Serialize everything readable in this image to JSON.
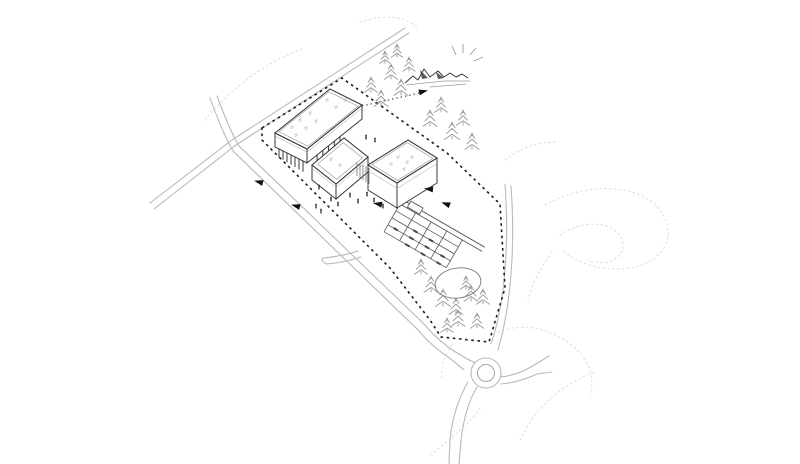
{
  "canvas": {
    "width": 800,
    "height": 464,
    "background": "#ffffff"
  },
  "colors": {
    "ink": "#3a3a3a",
    "ink_light": "#8a8a8a",
    "road": "#b9b9b9",
    "boundary": "#1c1c1c",
    "tree": "#969696",
    "contour": "#dfdfdf",
    "figure": "#141414",
    "arrow": "#111111",
    "roof_mark": "#b3b3b3",
    "mountain": "#3c3c3c",
    "mountain_ray": "#9a9a9a",
    "pond": "#7a7a7a",
    "parking": "#5a5a5a",
    "background": "#ffffff"
  },
  "scene": {
    "site_boundary": {
      "points": [
        [
          262,
          128
        ],
        [
          342,
          78
        ],
        [
          447,
          153
        ],
        [
          500,
          204
        ],
        [
          505,
          288
        ],
        [
          489,
          342
        ],
        [
          441,
          337
        ],
        [
          430,
          320
        ],
        [
          390,
          268
        ],
        [
          262,
          140
        ]
      ],
      "dash": "2.6 3.6",
      "width": 1.6
    },
    "roads": {
      "paths": [
        "M 150,203 L 232,140 L 405,28",
        "M 154,209 L 236,145 L 409,33",
        "M 217,96 Q 230,131 239,146 L 424,324 Q 434,336 448,347 Q 461,356 475,363",
        "M 210,98 Q 223,134 233,151 L 418,330 Q 428,342 441,352 Q 450,358 464,370",
        "M 505,184 C 509,240 506,300 491,344",
        "M 511,186 C 515,242 512,302 498,350",
        "M 477,387 C 469,400 463,420 461,441 L 459,464",
        "M 468,382 C 459,397 452,418 450,440 L 449,464",
        "M 500,377 C 513,376 525,371 536,364 L 549,356",
        "M 501,384 C 513,383 526,379 537,374 L 552,372",
        "M 358,251 C 346,255 334,257 323,258",
        "M 361,257 C 349,261 338,263 327,264",
        "M 323,258 Q 320,261 327,264"
      ]
    },
    "roundabout": {
      "cx": 486,
      "cy": 373,
      "r_outer": 15,
      "r_inner": 8.5
    },
    "view_axis": {
      "x1": 362,
      "y1": 106,
      "x2": 419,
      "y2": 93,
      "arrow": [
        423,
        91.5,
        -13
      ]
    },
    "mountain": {
      "ridge": "M 405,83 L 413,76 L 418,80 L 424,69 L 430,77 L 434,74 L 438,71 L 444,77 L 450,73 L 456,77 L 462,74 L 468,78",
      "shade": [
        [
          [
            420,
            70
          ],
          [
            428,
            78
          ],
          [
            422,
            79
          ]
        ],
        [
          [
            436,
            72
          ],
          [
            444,
            78
          ],
          [
            438,
            79
          ]
        ]
      ],
      "base": [
        "M 406,85 L 444,81 L 470,81",
        "M 430,87 L 466,84"
      ],
      "rays": [
        [
          456,
          55,
          452,
          46
        ],
        [
          463,
          53,
          463,
          44
        ],
        [
          470,
          55,
          476,
          48
        ],
        [
          474,
          61,
          483,
          57
        ]
      ]
    },
    "buildings": [
      {
        "name": "long-building",
        "roof": [
          [
            275,
            133
          ],
          [
            330,
            89
          ],
          [
            362,
            105
          ],
          [
            307,
            149
          ]
        ],
        "height": 14,
        "parapet": 0.045,
        "pilotis": {
          "depth": 8,
          "left": 7,
          "right": 5
        },
        "marks": [
          [
            292,
            127
          ],
          [
            300,
            120
          ],
          [
            310,
            113
          ],
          [
            296,
            135
          ],
          [
            306,
            128
          ],
          [
            316,
            121
          ],
          [
            327,
            100
          ],
          [
            336,
            107
          ],
          [
            345,
            100
          ]
        ]
      },
      {
        "name": "mid-building",
        "roof": [
          [
            312,
            165
          ],
          [
            344,
            138
          ],
          [
            368,
            157
          ],
          [
            336,
            184
          ]
        ],
        "height": 15,
        "parapet": 0.1,
        "pilotis": null,
        "marks": [
          [
            331,
            159
          ],
          [
            340,
            165
          ]
        ]
      },
      {
        "name": "right-building",
        "roof": [
          [
            368,
            165
          ],
          [
            408,
            140
          ],
          [
            437,
            158
          ],
          [
            397,
            183
          ]
        ],
        "height": 25,
        "parapet": 0.06,
        "pilotis": null,
        "marks": [
          [
            398,
            157
          ],
          [
            407,
            162
          ],
          [
            391,
            164
          ],
          [
            404,
            169
          ],
          [
            412,
            157
          ]
        ]
      }
    ],
    "connector_strokes": [
      [
        357,
        162,
        357,
        176
      ],
      [
        360,
        163,
        360,
        178
      ],
      [
        363,
        165,
        363,
        180
      ],
      [
        366,
        166,
        366,
        182
      ],
      [
        369,
        168,
        369,
        184
      ]
    ],
    "parking": {
      "origin": [
        400,
        204
      ],
      "dir": [
        0.866,
        0.5
      ],
      "perp": [
        -0.5,
        0.866
      ],
      "drive_len": 95,
      "grid_len": 72,
      "grid_depth": 32,
      "row_offsets": [
        8,
        16,
        24,
        32
      ],
      "col_steps": [
        0,
        18,
        36,
        54,
        72
      ],
      "kiosk": {
        "a": 8,
        "b": 22,
        "o1": -1,
        "o2": -8
      },
      "cars": [
        [
          0,
          1
        ],
        [
          1,
          0
        ],
        [
          1,
          1
        ],
        [
          1,
          2
        ],
        [
          2,
          0
        ],
        [
          2,
          1
        ],
        [
          2,
          2
        ],
        [
          3,
          1
        ],
        [
          3,
          2
        ]
      ]
    },
    "pond": {
      "cx": 458,
      "cy": 283,
      "rx": 23,
      "ry": 15,
      "rotate": -8
    },
    "trees": {
      "top": [
        [
          371,
          92,
          15
        ],
        [
          381,
          106,
          16
        ],
        [
          391,
          79,
          15
        ],
        [
          401,
          95,
          16
        ],
        [
          409,
          71,
          14
        ],
        [
          385,
          63,
          12
        ],
        [
          397,
          57,
          13
        ],
        [
          430,
          126,
          16
        ],
        [
          441,
          112,
          15
        ],
        [
          452,
          139,
          17
        ],
        [
          463,
          125,
          15
        ],
        [
          472,
          149,
          16
        ]
      ],
      "bottom": [
        [
          421,
          274,
          15
        ],
        [
          431,
          292,
          16
        ],
        [
          443,
          306,
          17
        ],
        [
          456,
          314,
          16
        ],
        [
          471,
          301,
          16
        ],
        [
          483,
          304,
          15
        ],
        [
          458,
          326,
          16
        ],
        [
          477,
          328,
          15
        ],
        [
          447,
          332,
          14
        ],
        [
          466,
          289,
          13
        ]
      ]
    },
    "people": [
      [
        316,
        208
      ],
      [
        321,
        213
      ],
      [
        331,
        201
      ],
      [
        338,
        206
      ],
      [
        350,
        197
      ],
      [
        358,
        203
      ],
      [
        367,
        196
      ],
      [
        374,
        202
      ],
      [
        383,
        208
      ],
      [
        366,
        139
      ],
      [
        375,
        142
      ],
      [
        319,
        189
      ]
    ],
    "direction_arrows": [
      [
        259,
        182,
        195
      ],
      [
        296,
        206,
        195
      ],
      [
        429,
        189,
        185
      ],
      [
        446,
        204,
        200
      ],
      [
        378,
        204,
        190
      ]
    ],
    "contours": [
      "M 205,120 C 235,85 265,62 305,48",
      "M 360,22 C 385,14 405,16 418,28",
      "M 545,205 C 590,180 640,185 660,210 C 678,235 665,262 630,268 C 600,272 575,262 562,250",
      "M 560,235 C 585,218 615,222 622,240 C 628,258 605,268 588,260",
      "M 552,252 C 540,268 532,285 528,300",
      "M 498,332 C 525,322 552,328 575,348 C 590,362 595,380 590,395",
      "M 520,440 C 535,408 560,385 595,372",
      "M 430,455 C 450,440 468,425 480,408",
      "M 452,345 C 445,355 440,368 442,380",
      "M 505,160 C 520,148 538,142 556,142"
    ]
  }
}
